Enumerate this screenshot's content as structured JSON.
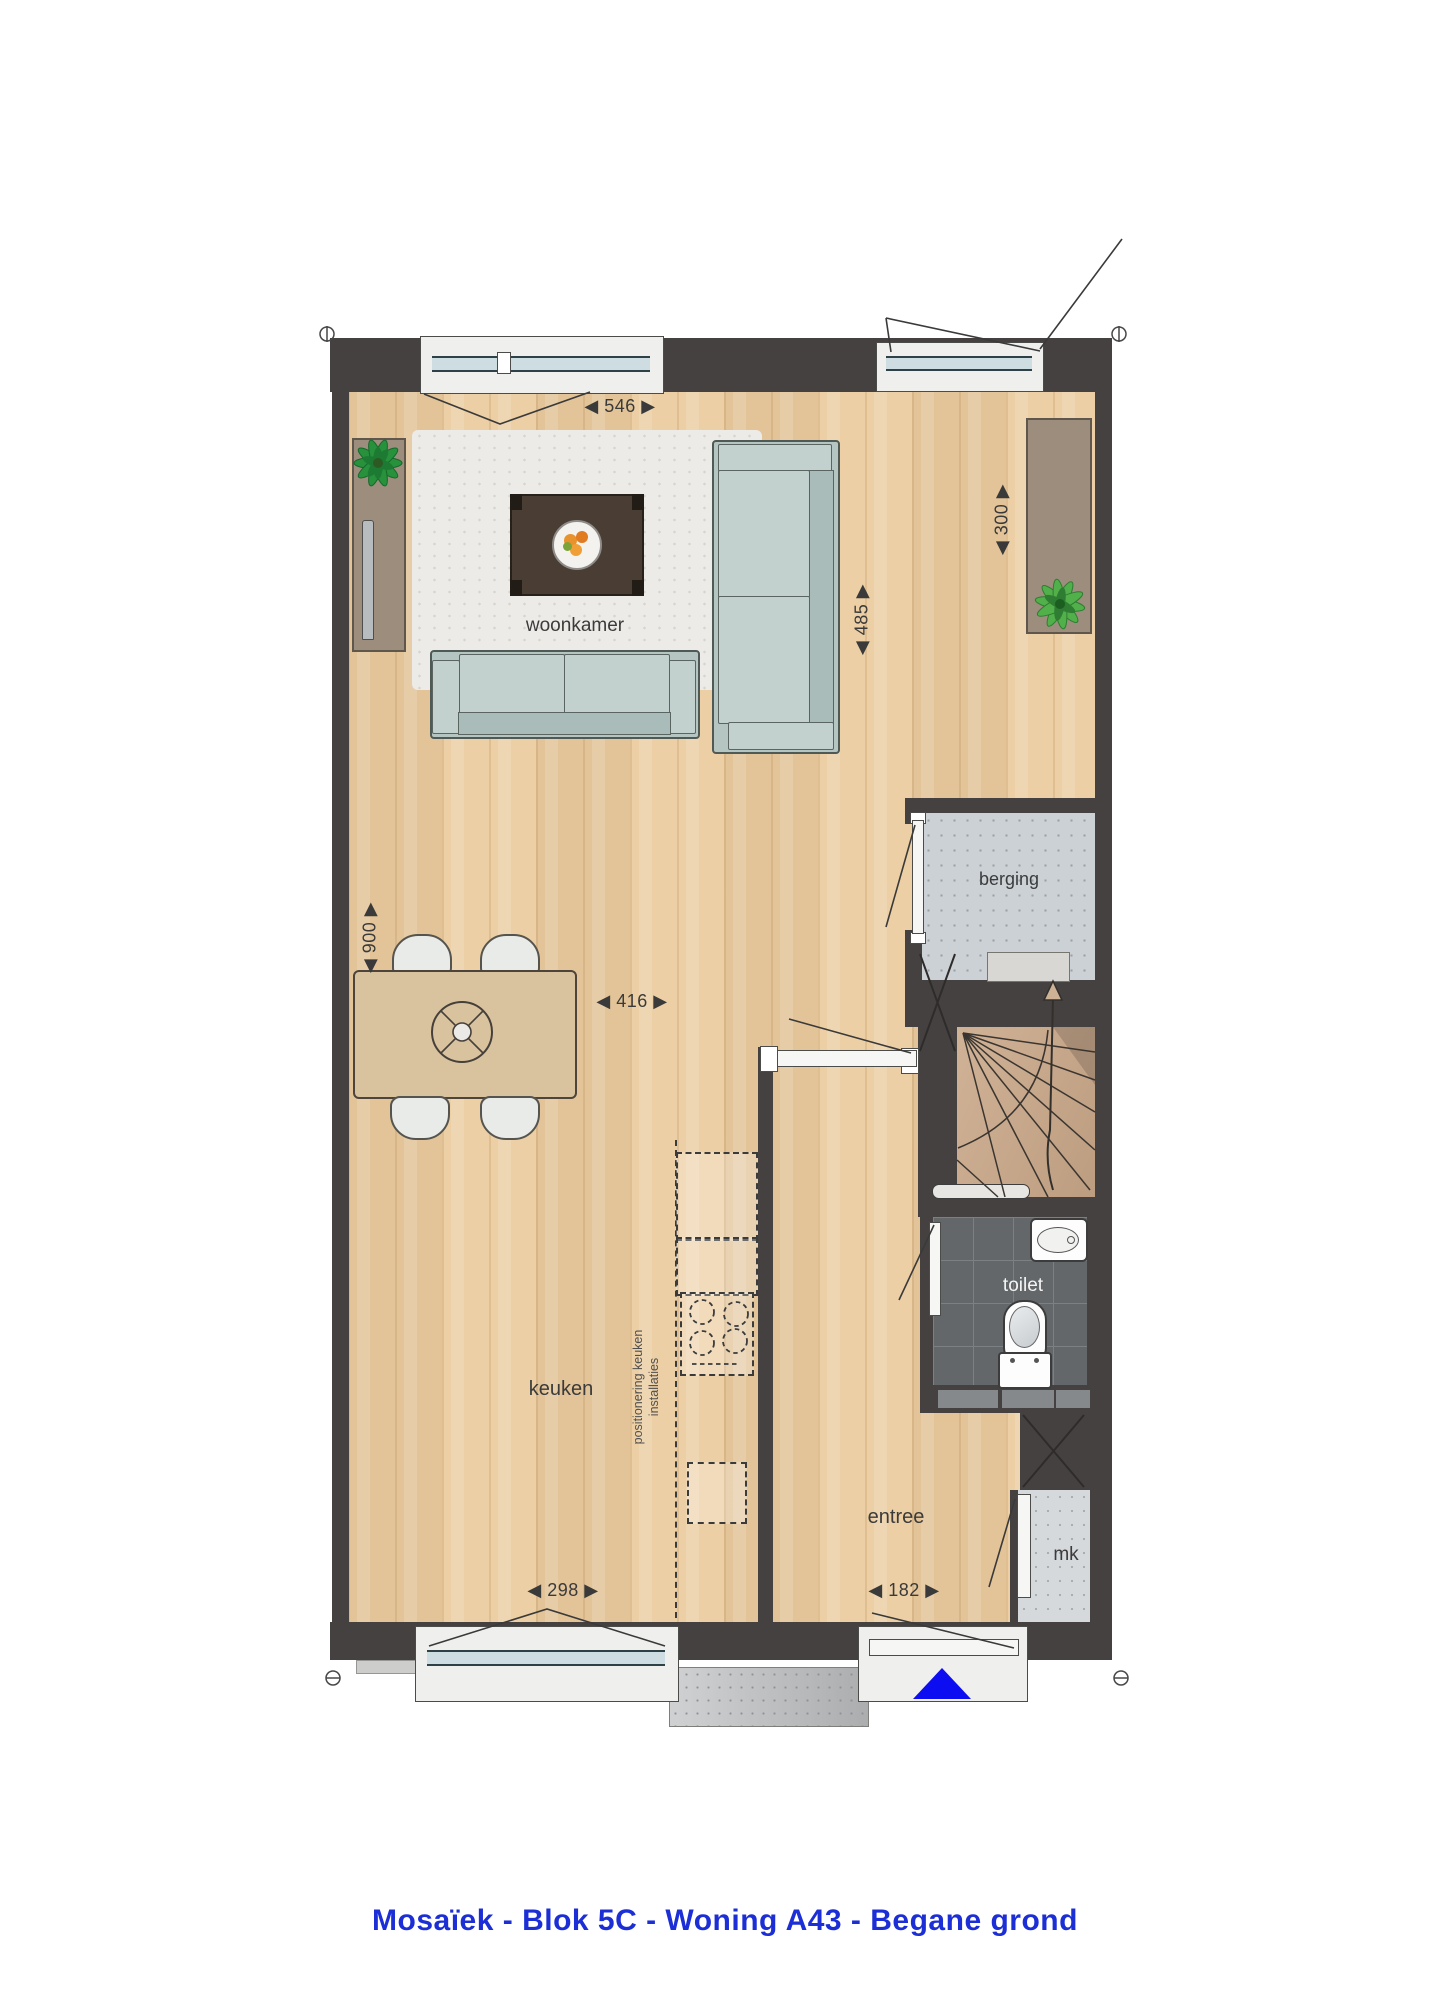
{
  "title": "Mosaïek - Blok 5C - Woning A43 - Begane grond",
  "rooms": {
    "woonkamer": "woonkamer",
    "keuken": "keuken",
    "entree": "entree",
    "berging": "berging",
    "toilet": "toilet",
    "meterkast": "mk"
  },
  "kitchen_note": {
    "line1": "positionering keuken",
    "line2": "installaties"
  },
  "dimensions": {
    "living_width": "◀ 546 ▶",
    "living_depth": "◀ 485 ▶",
    "sideboard_depth": "◀ 300 ▶",
    "dining_depth": "◀ 900 ▶",
    "kitchen_width": "◀ 416 ▶",
    "kitchen_window": "◀ 298 ▶",
    "front_door": "◀ 182 ▶"
  },
  "colors": {
    "wall": "#454140",
    "floor_wood": "#eccfa4",
    "title_blue": "#1c2fd6",
    "north_arrow_blue": "#0d0df2",
    "sofa": "#b4c5c2",
    "berging_floor": "#ccd1d5",
    "toilet_floor": "#63676a"
  }
}
